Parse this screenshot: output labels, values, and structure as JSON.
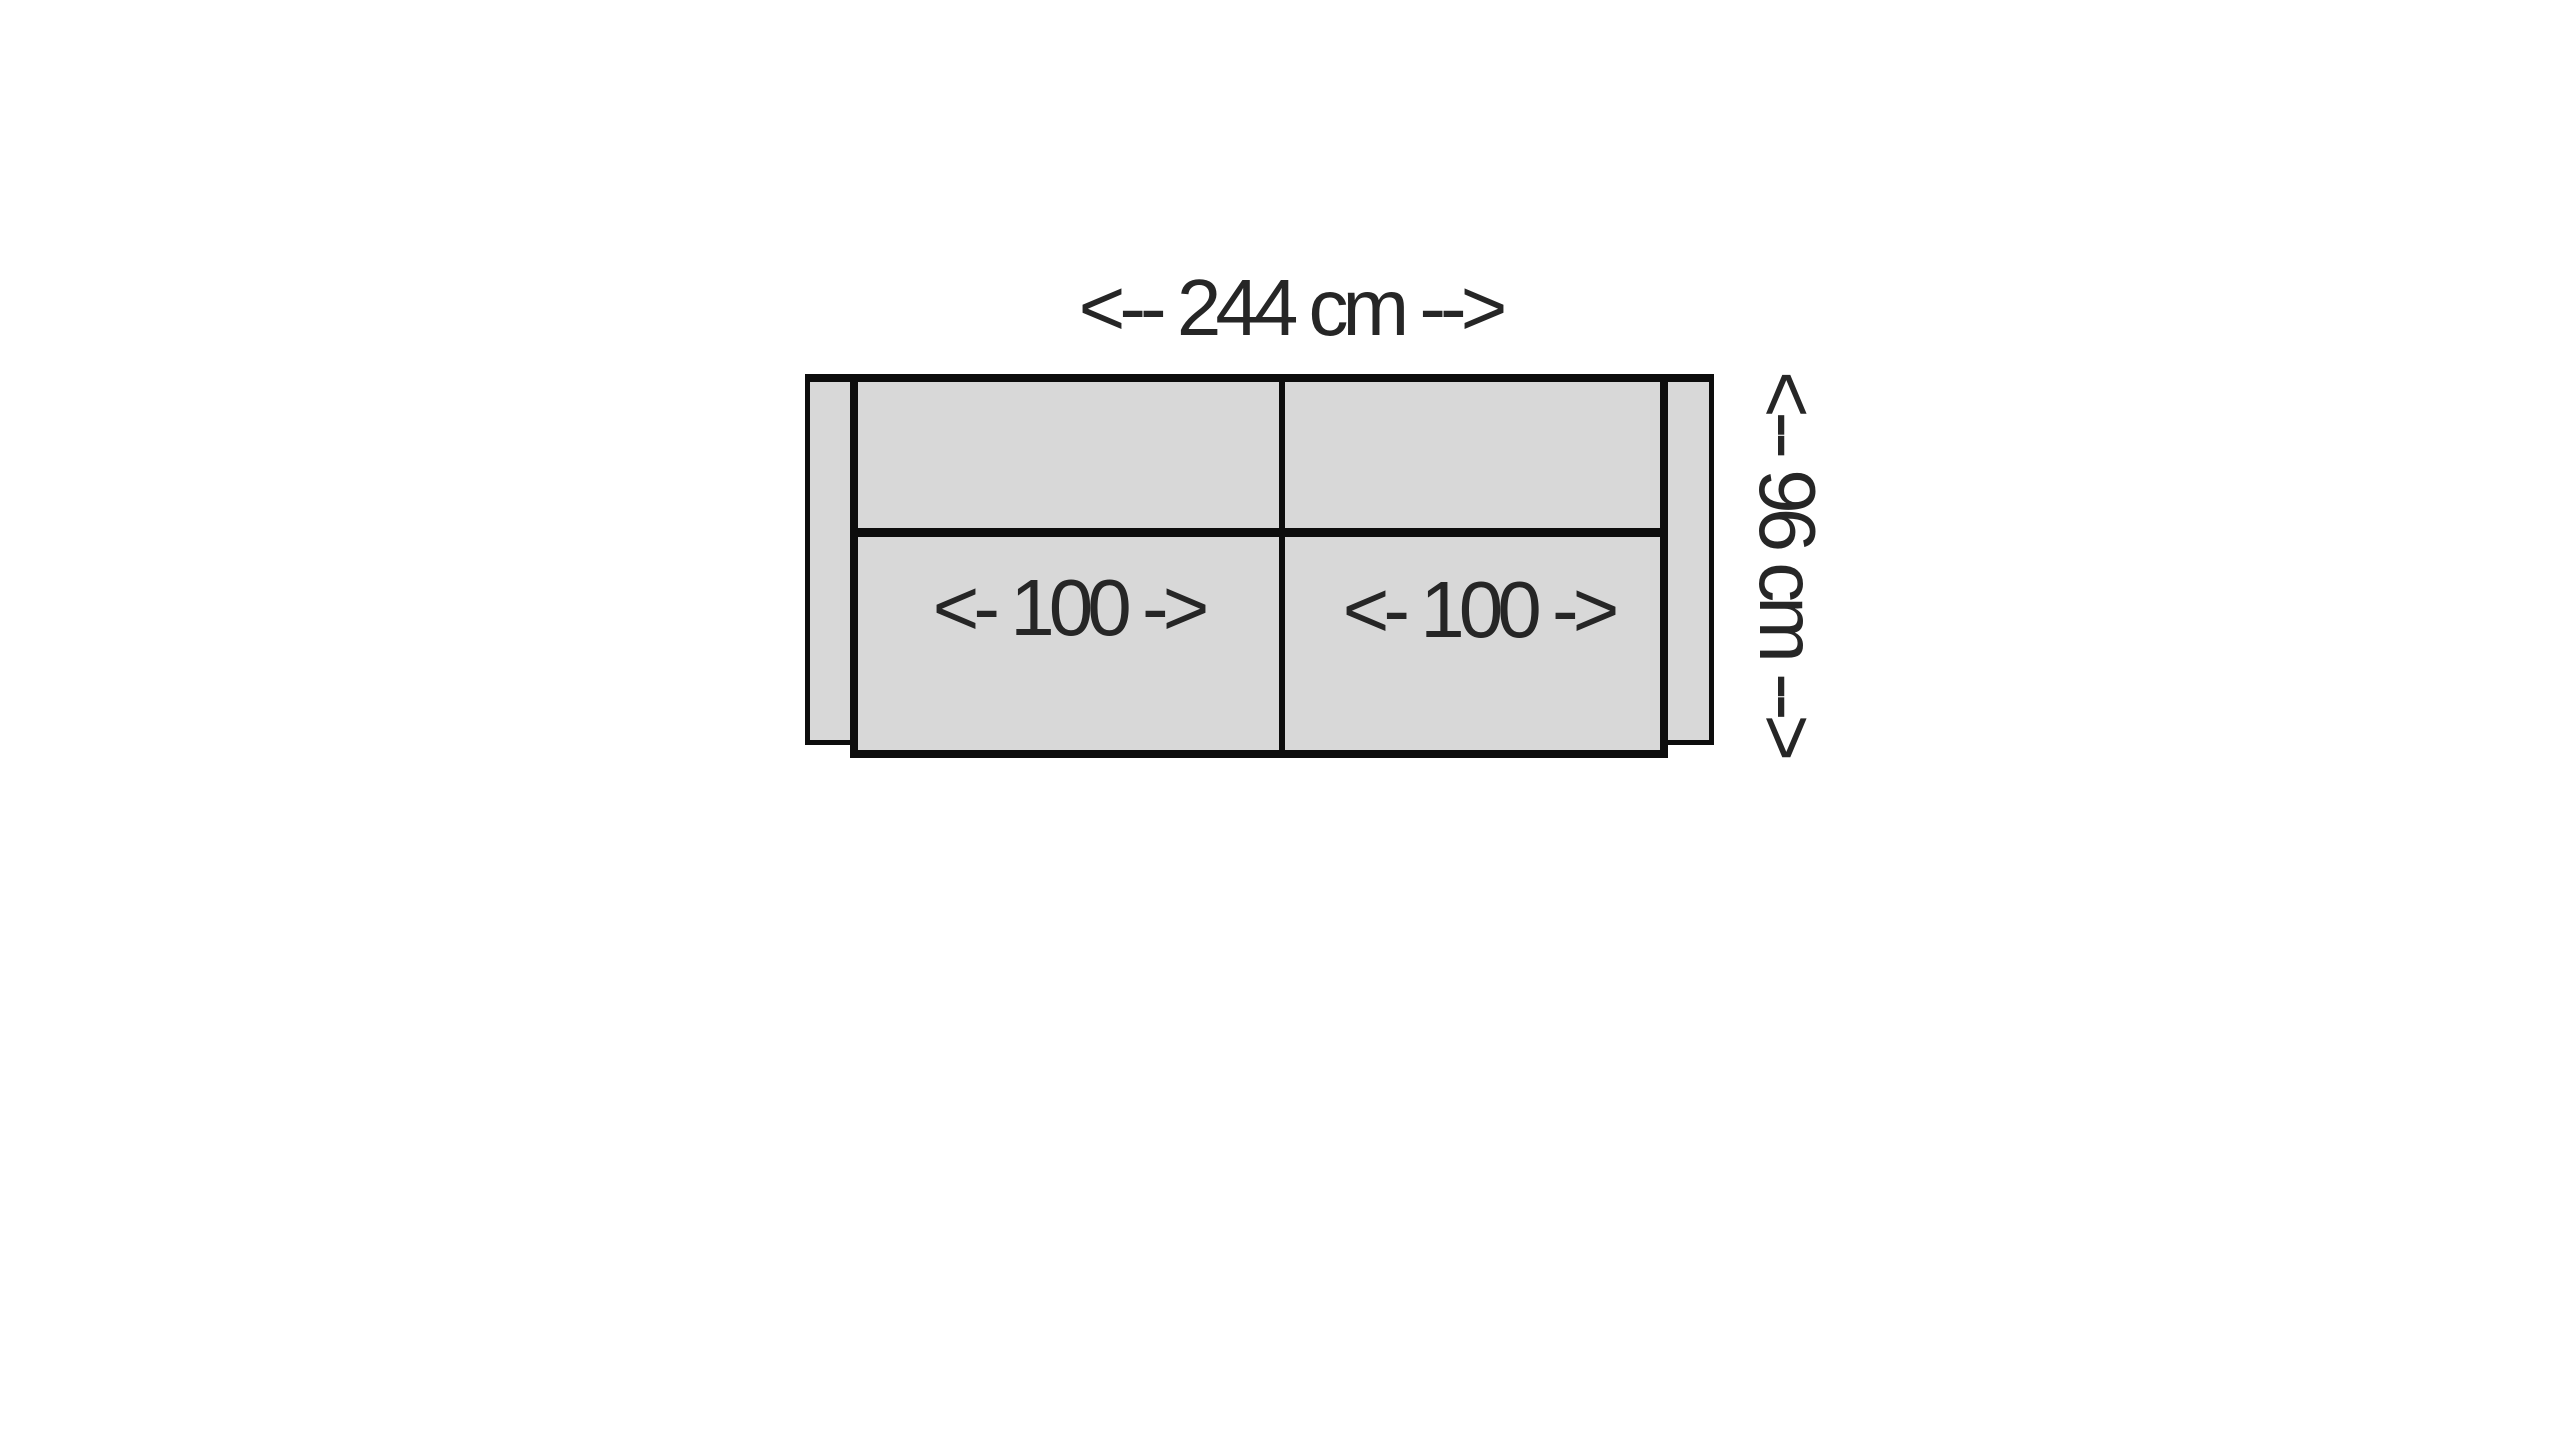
{
  "diagram": {
    "type": "sofa-top-view-dimension-diagram",
    "overall_width_label": "<-- 244 cm -->",
    "overall_depth_label": "<-- 96 cm -->",
    "seat_labels": [
      "<- 100 ->",
      "<- 100 ->"
    ],
    "colors": {
      "background": "#ffffff",
      "fill": "#d8d8d8",
      "outline": "#0d0d0d",
      "text": "#262626"
    }
  }
}
